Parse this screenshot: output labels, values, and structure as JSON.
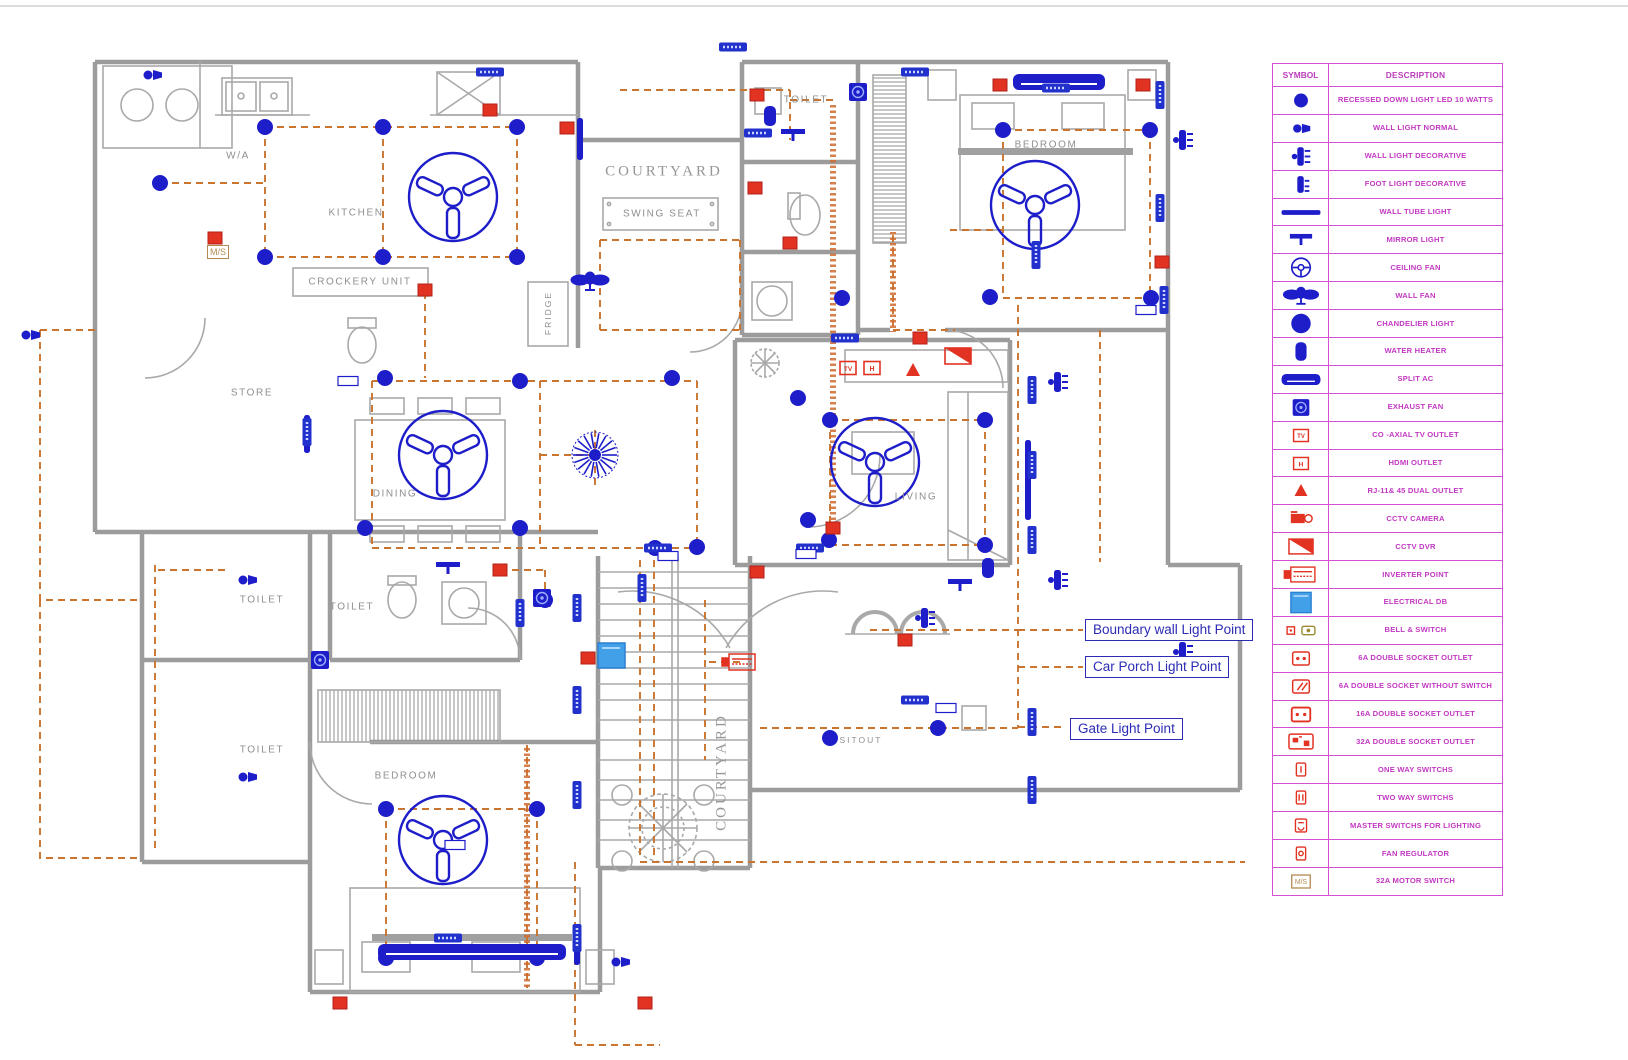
{
  "colors": {
    "blue": "#1d1dc9",
    "red": "#e23222",
    "orange": "#c9742f",
    "magenta": "#d44fd4",
    "magenta_text": "#c238c2",
    "wall": "#9c9c9c",
    "furniture": "#a9a9a9",
    "label_gray": "#8f8f8f",
    "db_blue": "#41a0e8",
    "tan": "#b38a52",
    "annotation_blue": "#2b2bb4"
  },
  "legend": {
    "header": {
      "symbol": "SYMBOL",
      "description": "DESCRIPTION"
    },
    "rows": [
      {
        "icon": "recessed-down-light",
        "label": "RECESSED DOWN LIGHT LED 10 WATTS"
      },
      {
        "icon": "wall-light-normal",
        "label": "WALL LIGHT NORMAL"
      },
      {
        "icon": "wall-light-decorative",
        "label": "WALL LIGHT DECORATIVE"
      },
      {
        "icon": "foot-light-decorative",
        "label": "FOOT LIGHT DECORATIVE"
      },
      {
        "icon": "wall-tube-light",
        "label": "WALL TUBE LIGHT"
      },
      {
        "icon": "mirror-light",
        "label": "MIRROR LIGHT"
      },
      {
        "icon": "ceiling-fan",
        "label": "CEILING FAN"
      },
      {
        "icon": "wall-fan",
        "label": "WALL FAN"
      },
      {
        "icon": "chandelier-light",
        "label": "CHANDELIER LIGHT"
      },
      {
        "icon": "water-heater",
        "label": "WATER HEATER"
      },
      {
        "icon": "split-ac",
        "label": "SPLIT AC"
      },
      {
        "icon": "exhaust-fan",
        "label": "EXHAUST FAN"
      },
      {
        "icon": "tv-outlet",
        "label": "CO -AXIAL TV OUTLET"
      },
      {
        "icon": "hdmi-outlet",
        "label": "HDMI OUTLET"
      },
      {
        "icon": "rj-outlet",
        "label": "RJ-11& 45 DUAL OUTLET"
      },
      {
        "icon": "cctv-camera",
        "label": "CCTV CAMERA"
      },
      {
        "icon": "cctv-dvr",
        "label": "CCTV DVR"
      },
      {
        "icon": "inverter-point",
        "label": "INVERTER POINT"
      },
      {
        "icon": "electrical-db",
        "label": "ELECTRICAL DB"
      },
      {
        "icon": "bell-switch",
        "label": "BELL & SWITCH"
      },
      {
        "icon": "socket-6a",
        "label": "6A DOUBLE SOCKET OUTLET"
      },
      {
        "icon": "socket-6a-ns",
        "label": "6A DOUBLE SOCKET WITHOUT SWITCH"
      },
      {
        "icon": "socket-16a",
        "label": "16A DOUBLE SOCKET OUTLET"
      },
      {
        "icon": "socket-32a",
        "label": "32A DOUBLE SOCKET OUTLET"
      },
      {
        "icon": "one-way-switch",
        "label": "ONE WAY SWITCHS"
      },
      {
        "icon": "two-way-switch",
        "label": "TWO WAY SWITCHS"
      },
      {
        "icon": "master-switch",
        "label": "MASTER SWITCHS FOR LIGHTING"
      },
      {
        "icon": "fan-regulator",
        "label": "FAN REGULATOR"
      },
      {
        "icon": "motor-switch",
        "label": "32A MOTOR SWITCH"
      }
    ]
  },
  "annotations": [
    {
      "text": "Boundary wall  Light Point",
      "x": 1085,
      "y": 619
    },
    {
      "text": "Car Porch Light Point",
      "x": 1085,
      "y": 656
    },
    {
      "text": "Gate Light Point",
      "x": 1070,
      "y": 718
    }
  ],
  "rooms": [
    {
      "text": "W/A",
      "x": 238,
      "y": 156
    },
    {
      "text": "KITCHEN",
      "x": 356,
      "y": 213
    },
    {
      "text": "CROCKERY UNIT",
      "x": 360,
      "y": 282
    },
    {
      "text": "STORE",
      "x": 252,
      "y": 393
    },
    {
      "text": "DINING",
      "x": 395,
      "y": 494
    },
    {
      "text": "COURTYARD",
      "x": 664,
      "y": 172,
      "style": "serif"
    },
    {
      "text": "SWING SEAT",
      "x": 662,
      "y": 214
    },
    {
      "text": "FRIDGE",
      "x": 548,
      "y": 313,
      "rot": -90,
      "style": "small"
    },
    {
      "text": "TOILET",
      "x": 806,
      "y": 100
    },
    {
      "text": "BEDROOM",
      "x": 1046,
      "y": 145
    },
    {
      "text": "LIVING",
      "x": 916,
      "y": 497
    },
    {
      "text": "SITOUT",
      "x": 861,
      "y": 740,
      "style": "small"
    },
    {
      "text": "TOILET",
      "x": 262,
      "y": 600
    },
    {
      "text": "TOILET",
      "x": 352,
      "y": 607
    },
    {
      "text": "TOILET",
      "x": 262,
      "y": 750
    },
    {
      "text": "BEDROOM",
      "x": 406,
      "y": 776
    },
    {
      "text": "COURTYARD",
      "x": 722,
      "y": 772,
      "rot": -90,
      "style": "serif"
    },
    {
      "text": "M/S",
      "x": 218,
      "y": 252,
      "style": "ms"
    }
  ],
  "plan": {
    "lights": [
      [
        265,
        127
      ],
      [
        383,
        127
      ],
      [
        517,
        127
      ],
      [
        160,
        183
      ],
      [
        265,
        257
      ],
      [
        383,
        257
      ],
      [
        517,
        257
      ],
      [
        385,
        378
      ],
      [
        520,
        381
      ],
      [
        672,
        378
      ],
      [
        798,
        398
      ],
      [
        365,
        528
      ],
      [
        520,
        528
      ],
      [
        655,
        548
      ],
      [
        808,
        520
      ],
      [
        830,
        420
      ],
      [
        985,
        420
      ],
      [
        985,
        545
      ],
      [
        990,
        297
      ],
      [
        1003,
        130
      ],
      [
        1150,
        130
      ],
      [
        1151,
        298
      ],
      [
        842,
        298
      ],
      [
        697,
        547
      ],
      [
        829,
        540
      ],
      [
        830,
        738
      ],
      [
        938,
        728
      ],
      [
        386,
        809
      ],
      [
        537,
        809
      ],
      [
        386,
        958
      ],
      [
        537,
        958
      ],
      [
        545,
        600
      ]
    ],
    "fans": [
      [
        453,
        197
      ],
      [
        443,
        455
      ],
      [
        875,
        462
      ],
      [
        1035,
        205
      ],
      [
        443,
        840
      ]
    ],
    "chandeliers": [
      [
        595,
        455
      ]
    ],
    "wall_fans": [
      [
        590,
        281
      ]
    ],
    "mirror_lights": [
      [
        793,
        135
      ],
      [
        960,
        585
      ],
      [
        448,
        568
      ]
    ],
    "water_heaters": [
      [
        770,
        116
      ],
      [
        988,
        568
      ]
    ],
    "exhaust_fans": [
      [
        858,
        92
      ],
      [
        542,
        598
      ],
      [
        320,
        660
      ]
    ],
    "tube_lights": [
      [
        580,
        118,
        42
      ],
      [
        1028,
        440,
        80
      ],
      [
        307,
        415,
        38
      ],
      [
        577,
        925,
        40
      ]
    ],
    "split_acs": [
      [
        1013,
        82,
        92
      ],
      [
        378,
        952,
        188
      ]
    ],
    "wall_lights": [
      [
        152,
        75
      ],
      [
        30,
        335
      ],
      [
        247,
        580
      ],
      [
        247,
        777
      ],
      [
        620,
        962
      ]
    ],
    "deco_lights": [
      [
        1058,
        382
      ],
      [
        1058,
        580
      ],
      [
        925,
        618
      ],
      [
        1183,
        140
      ],
      [
        1183,
        652
      ]
    ],
    "sockets": [
      [
        490,
        110
      ],
      [
        215,
        238
      ],
      [
        425,
        290
      ],
      [
        567,
        128
      ],
      [
        757,
        95
      ],
      [
        755,
        188
      ],
      [
        790,
        243
      ],
      [
        920,
        338
      ],
      [
        1000,
        85
      ],
      [
        1143,
        85
      ],
      [
        1162,
        262
      ],
      [
        500,
        570
      ],
      [
        588,
        658
      ],
      [
        757,
        572
      ],
      [
        905,
        640
      ],
      [
        340,
        1003
      ],
      [
        645,
        1003
      ],
      [
        833,
        528
      ]
    ],
    "tv_outlets": [
      [
        848,
        368
      ]
    ],
    "hdmi_outlets": [
      [
        872,
        368
      ]
    ],
    "rj_outlets": [
      [
        913,
        370
      ]
    ],
    "cctv_dvrs": [
      [
        958,
        356
      ]
    ],
    "inverters": [
      [
        740,
        662
      ]
    ],
    "dbs": [
      [
        598,
        643
      ]
    ],
    "tags_h": [
      [
        490,
        72
      ],
      [
        915,
        72
      ],
      [
        733,
        47
      ],
      [
        1056,
        88
      ],
      [
        758,
        133
      ],
      [
        658,
        548
      ],
      [
        810,
        548
      ],
      [
        915,
        700
      ],
      [
        448,
        938
      ],
      [
        845,
        338
      ]
    ],
    "tags_v": [
      [
        1160,
        95
      ],
      [
        1160,
        208
      ],
      [
        1164,
        300
      ],
      [
        1036,
        255
      ],
      [
        1032,
        390
      ],
      [
        1032,
        465
      ],
      [
        1032,
        540
      ],
      [
        1032,
        722
      ],
      [
        1032,
        790
      ],
      [
        307,
        432
      ],
      [
        520,
        613
      ],
      [
        577,
        608
      ],
      [
        577,
        700
      ],
      [
        577,
        795
      ],
      [
        577,
        938
      ],
      [
        642,
        588
      ]
    ],
    "small_tags": [
      [
        348,
        381
      ],
      [
        668,
        556
      ],
      [
        806,
        554
      ],
      [
        946,
        708
      ],
      [
        1146,
        310
      ],
      [
        455,
        845
      ]
    ]
  }
}
